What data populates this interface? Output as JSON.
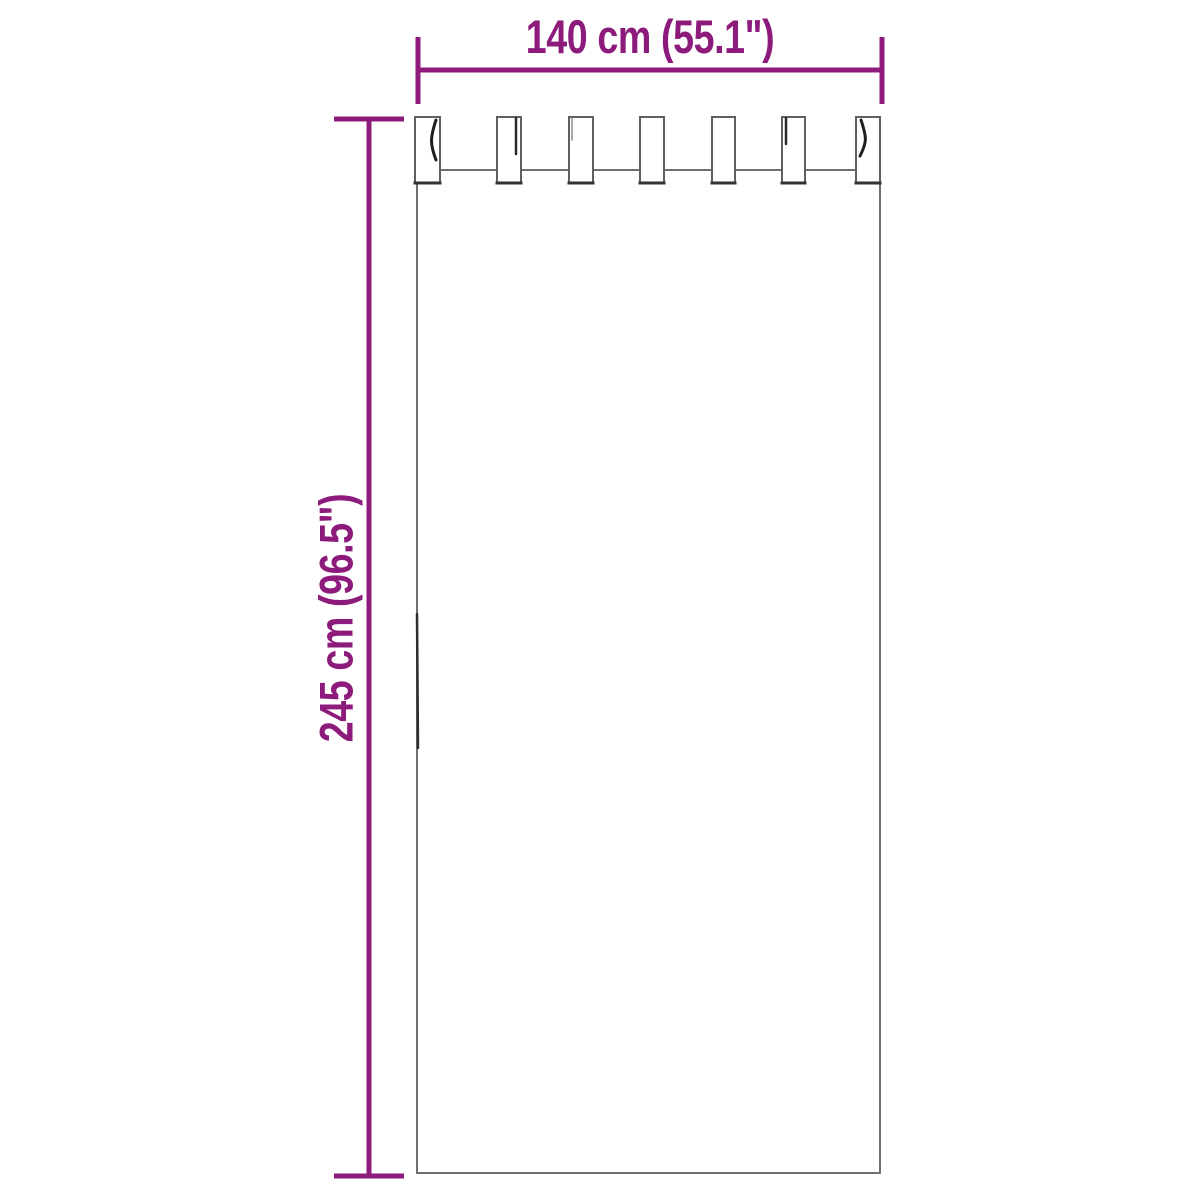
{
  "diagram": {
    "type": "product-dimension-diagram",
    "subject": "tab-top curtain panel, front view outline",
    "width_label": "140 cm (55.1\")",
    "height_label": "245 cm (96.5\")",
    "tabs_count": 7,
    "accent_color": "#8C1B7C",
    "outline_color": "#6F6F6F",
    "background_color": "#FFFFFF"
  }
}
